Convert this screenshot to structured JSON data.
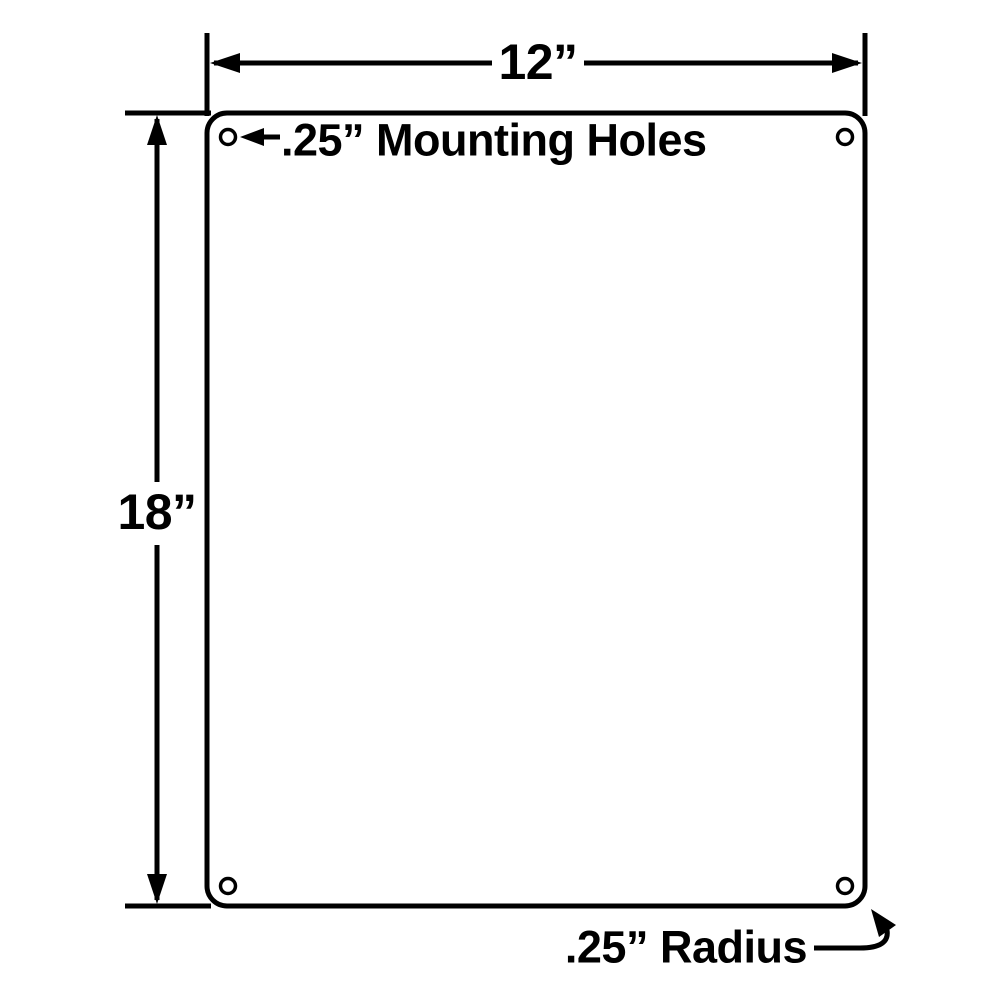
{
  "canvas": {
    "background": "#ffffff",
    "line_color": "#000000",
    "plate_fill": "#ffffff"
  },
  "labels": {
    "width": "12”",
    "height": "18”",
    "mounting_holes": ".25” Mounting Holes",
    "corner_radius": ".25” Radius"
  }
}
